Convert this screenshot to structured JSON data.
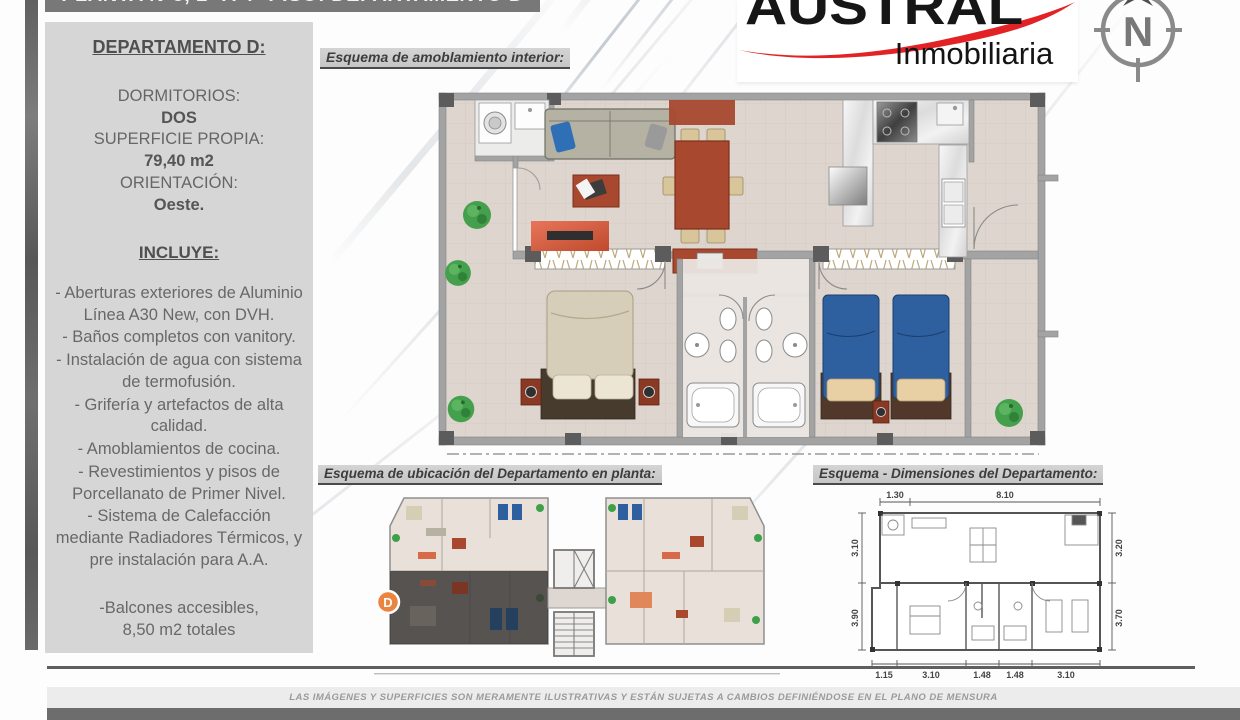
{
  "title_bar": "PLANTA N°3, 2° A 4° PISO: DEPARTAMENTO D",
  "logo": {
    "brand": "AUSTRAL",
    "subtitle": "Inmobiliaria",
    "compass_letter": "N"
  },
  "sidebar": {
    "heading": "DEPARTAMENTO D:",
    "specs": [
      {
        "label": "DORMITORIOS:",
        "value": "DOS"
      },
      {
        "label": "SUPERFICIE PROPIA:",
        "value": "79,40 m2"
      },
      {
        "label": "ORIENTACIÓN:",
        "value": "Oeste."
      }
    ],
    "includes_heading": "INCLUYE:",
    "includes": [
      "- Aberturas exteriores de Aluminio Línea A30 New, con DVH.",
      "- Baños completos con vanitory.",
      "- Instalación de agua con sistema de termofusión.",
      "- Grifería y artefactos de alta calidad.",
      "- Amoblamientos de cocina.",
      "- Revestimientos y pisos de Porcellanato de Primer Nivel.",
      "- Sistema de Calefacción mediante Radiadores Térmicos, y pre instalación para A.A."
    ],
    "balconies_line1": "-Balcones accesibles,",
    "balconies_line2": "8,50 m2 totales"
  },
  "sections": {
    "furnishing": "Esquema de amoblamiento interior:",
    "location": "Esquema de ubicación del Departamento en planta:",
    "dimensions": "Esquema - Dimensiones del Departamento:"
  },
  "location_plan": {
    "unit_label": "D"
  },
  "dims": {
    "top": [
      "1.30",
      "8.10"
    ],
    "left": [
      "3.10",
      "3.90"
    ],
    "right": [
      "3.20",
      "3.70"
    ],
    "bottom": [
      "1.15",
      "3.10",
      "1.48",
      "1.48",
      "3.10"
    ]
  },
  "footer": {
    "disclaimer": "LAS IMÁGENES Y SUPERFICIES SON MERAMENTE ILUSTRATIVAS Y ESTÁN SUJETAS A CAMBIOS DEFINIÉNDOSE EN EL PLANO DE MENSURA"
  },
  "colors": {
    "accent_red": "#e32226",
    "unit_badge_orange": "#ea8440",
    "furniture_red": "#a8492f",
    "bed_blue": "#2e5f9e",
    "title_bar_gray": "#787878"
  }
}
